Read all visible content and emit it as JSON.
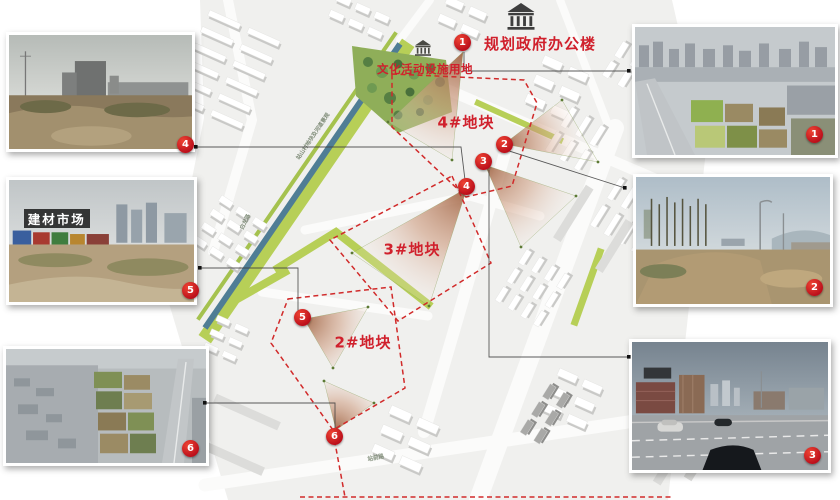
{
  "header": {
    "gov_label": "规划政府办公楼",
    "culture_label": "文化活动设施用地"
  },
  "plots": [
    {
      "label": "4#地块"
    },
    {
      "label": "3#地块"
    },
    {
      "label": "2#地块"
    }
  ],
  "road_labels": {
    "river_corridor": "站山村地块及河道景观",
    "road_west": "白龙路",
    "road_south": "站前路"
  },
  "markers": {
    "m1": "1",
    "m2": "2",
    "m3": "3",
    "m4": "4",
    "m5": "5",
    "m6": "6"
  },
  "photos": [
    {
      "badge": "1"
    },
    {
      "badge": "2"
    },
    {
      "badge": "3"
    },
    {
      "badge": "4"
    },
    {
      "badge": "5",
      "caption": "建材市场"
    },
    {
      "badge": "6"
    }
  ],
  "colors": {
    "accent_red": "#c0101c",
    "dashed_red": "#d12a2a",
    "view_cone": "#a86a48",
    "greenway": "#b7cf57",
    "river": "#4f7d95"
  }
}
